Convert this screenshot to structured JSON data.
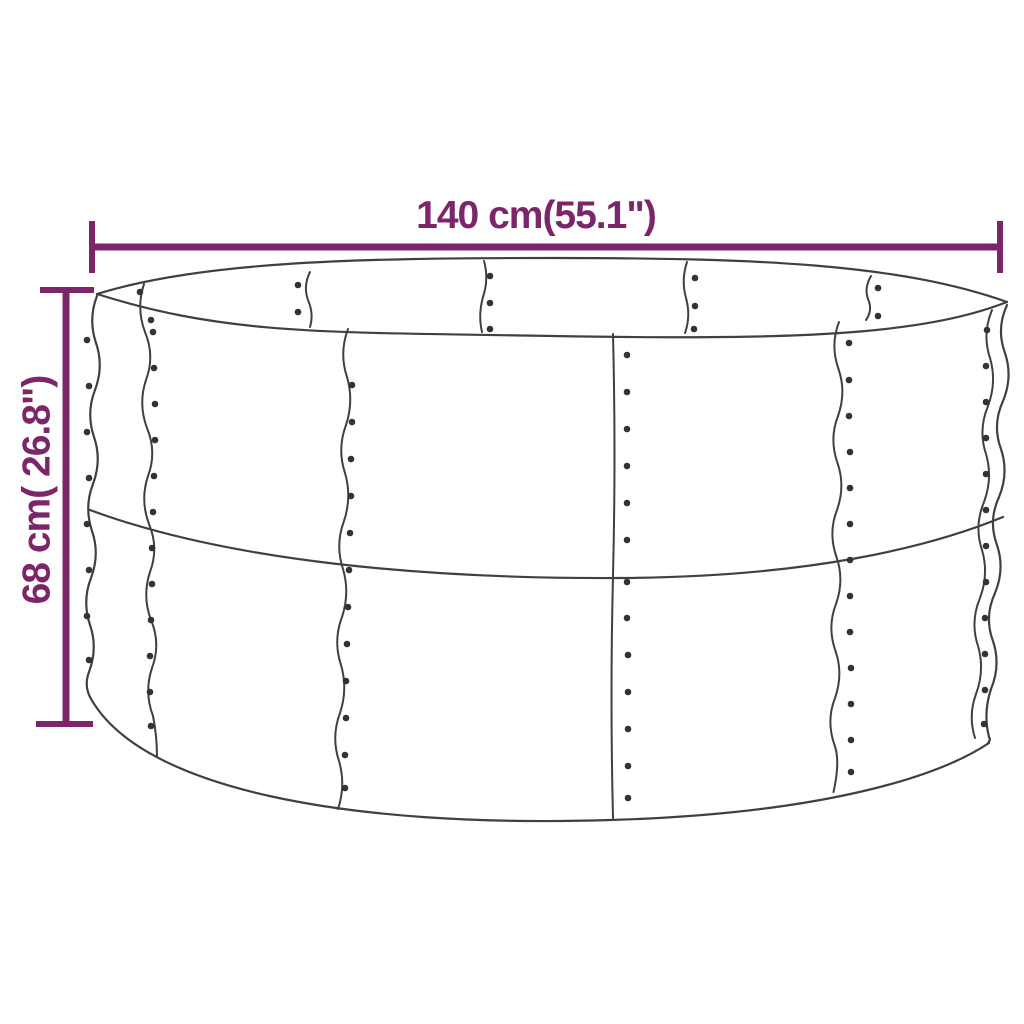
{
  "figure": {
    "type": "product-dimension-diagram",
    "subject": "round metal raised garden bed (line drawing with riveted panels)",
    "width_label": "140 cm(55.1\")",
    "height_label": "68 cm( 26.8\")"
  },
  "colors": {
    "dimension_accent": "#7C2669",
    "drawing_outline": "#404040",
    "background": "#FFFFFF"
  }
}
